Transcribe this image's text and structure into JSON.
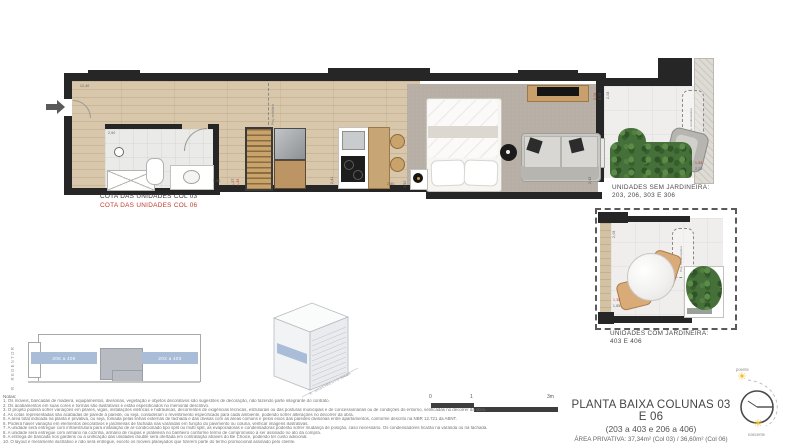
{
  "plan": {
    "cota_col03": "COTA DAS UNIDADES COL 03",
    "cota_col06": "COTA DAS UNIDADES COL 06",
    "proj_mobiliario": "Proj. mobiliário",
    "dims": {
      "entry": "12,40",
      "bath": "2,50",
      "hall": "1,50",
      "hall_v1": "1,37",
      "hall_v2": "1,43",
      "kitchen_v": "2,41",
      "bed_h": "2,50",
      "bed_v": "2,50",
      "living_v": "2,43",
      "div_red": "3,08",
      "div_dark": "5,08"
    }
  },
  "balcony_sem": {
    "title": "UNIDADES SEM JARDINEIRA:",
    "units": "203, 206, 303 E 306",
    "proj": "Proj. condensadora",
    "dim_red": "1,98",
    "dim_dark": "2,22",
    "dim_side": "2,08"
  },
  "balcony_com": {
    "title": "UNIDADES COM JARDINEIRA:",
    "units": "403 E 406",
    "proj": "Proj. condensadora",
    "dim_red": "1,38",
    "dim_dark": "1,85",
    "dim_side": "2,08"
  },
  "keyplan": {
    "street": "R. REDENTOR",
    "left_units": "206 a 406",
    "right_units": "203 a 403"
  },
  "axon": {
    "street": "R. NASCIMENTO SILVA"
  },
  "scalebar": {
    "t0": "0",
    "t1": "1",
    "t3": "3m"
  },
  "titleblock": {
    "title": "PLANTA BAIXA COLUNAS 03 E 06",
    "subtitle": "(203 a 403 e 206 a 406)",
    "area": "ÁREA PRIVATIVA: 37,34m² (Col 03) / 36,60m² (Col 06)"
  },
  "compass": {
    "west": "poente",
    "east": "nascente"
  },
  "notes": {
    "title": "Notas:",
    "items": [
      "1. Os móveis, bancadas de madeira, equipamentos, divisórias, vegetação e objetos decorativos são sugestões de decoração, não fazendo parte integrante do contrato.",
      "2. Os acabamentos em suas cores e formas são ilustrativos e estão especificados no memorial descritivo.",
      "3. O projeto poderá sofrer variações em pilares, vigas, instalações elétricas e hidráulicas, decorrentes de exigências técnicas, estruturais ou das posturas municipais e de concessionárias ou de condições do entorno, verificadas no decorrer da obra.",
      "4. As cotas representadas são acabadas de parede a parede, ou seja, consideram o revestimento especificado para cada ambiente, podendo sofrer alterações no decorrer da obra.",
      "5. A área total indicada na planta é privativa, ou seja, tomada pelas linhas externas de fachada e das divisas com as áreas comuns e pelos eixos das paredes divisórias entre apartamentos, conforme descrito na NBR 12.721 da ABNT.",
      "6. Poderá haver variação em elementos decorativos e jardineiras de fachada nas varandas em função do pavimento ou coluna, verificar imagens ilustrativas.",
      "7. A unidade será entregue com infraestrutura para instalação de ar-condicionado tipo split ou multi split, as evaporadoras e condensadoras poderão sofrer mudança de posição, caso necessário. Os condensadores ficarão na varanda ou na fachada.",
      "8. A unidade será entregue com armário na cozinha, armário de roupas e prateleira no banheiro conforme termo de compromisso a ser assinado no ato da compra.",
      "9. A entrega de bancada nos gardens ou a unificação das unidades double será ofertada em contratação através do Be Choice, podendo ter custo adicional.",
      "10. O layout é meramente ilustrativo e não será entregue, exceto os móveis planejados que fizerem parte do termo promocional assinado pelo cliente."
    ]
  },
  "colors": {
    "wall": "#262626",
    "wood": "#d8c7ab",
    "accent_blue": "#a9bcd8",
    "highlight_red": "#c0392b",
    "green": "#46703a"
  }
}
